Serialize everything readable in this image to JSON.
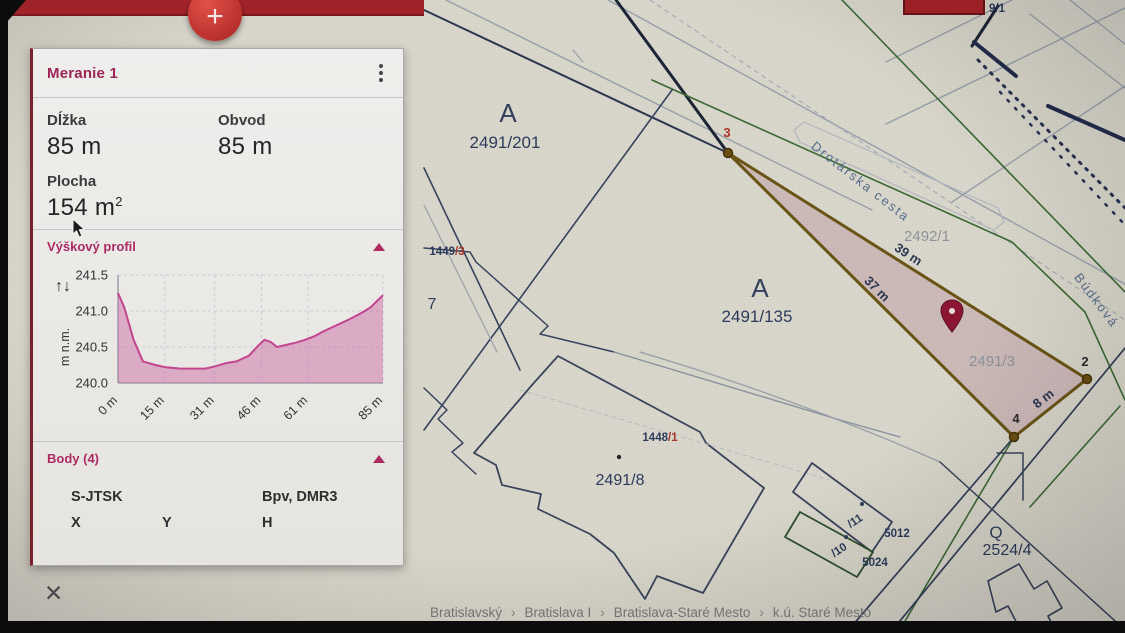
{
  "app": {
    "fab_label": "+",
    "breadcrumb_separator": "›",
    "breadcrumb": [
      "Bratislavský",
      "Bratislava I",
      "Bratislava-Staré Mesto",
      "k.ú. Staré Mesto"
    ]
  },
  "panel": {
    "title": "Meranie 1",
    "close_icon": "✕",
    "metrics": [
      {
        "label": "Dĺžka",
        "value": "85 m",
        "sup": ""
      },
      {
        "label": "Obvod",
        "value": "85 m",
        "sup": ""
      },
      {
        "label": "Plocha",
        "value": "154 m",
        "sup": "2"
      }
    ],
    "sections": {
      "profile": {
        "title": "Výškový profil",
        "collapse_icon": "▲",
        "updown_icon": "↑↓"
      },
      "points": {
        "title": "Body (4)",
        "collapse_icon": "▲",
        "coord_system_headers": [
          {
            "label": "S-JTSK"
          },
          {
            "label": "Bpv, DMR3"
          }
        ],
        "columns": [
          "X",
          "Y",
          "H"
        ]
      }
    }
  },
  "chart_data": {
    "type": "area",
    "title": "Výškový profil",
    "ylabel": "m n.m.",
    "xlabel": "",
    "xlim": [
      0,
      85
    ],
    "ylim": [
      240.0,
      241.5
    ],
    "yticks": [
      240.0,
      240.5,
      241.0,
      241.5
    ],
    "xticks": [
      {
        "pos": 0,
        "label": "0 m"
      },
      {
        "pos": 15,
        "label": "15 m"
      },
      {
        "pos": 31,
        "label": "31 m"
      },
      {
        "pos": 46,
        "label": "46 m"
      },
      {
        "pos": 61,
        "label": "61 m"
      },
      {
        "pos": 85,
        "label": "85 m"
      }
    ],
    "grid": true,
    "line_color": "#c2458f",
    "fill_color": "rgba(201,95,158,0.45)",
    "profile": [
      [
        0,
        241.25
      ],
      [
        2,
        241.05
      ],
      [
        5,
        240.6
      ],
      [
        8,
        240.3
      ],
      [
        12,
        240.25
      ],
      [
        15,
        240.22
      ],
      [
        20,
        240.2
      ],
      [
        25,
        240.2
      ],
      [
        28,
        240.2
      ],
      [
        31,
        240.23
      ],
      [
        35,
        240.28
      ],
      [
        38,
        240.3
      ],
      [
        42,
        240.38
      ],
      [
        45,
        240.52
      ],
      [
        47,
        240.6
      ],
      [
        49,
        240.57
      ],
      [
        51,
        240.5
      ],
      [
        54,
        240.53
      ],
      [
        57,
        240.56
      ],
      [
        60,
        240.6
      ],
      [
        63,
        240.65
      ],
      [
        66,
        240.72
      ],
      [
        70,
        240.8
      ],
      [
        74,
        240.88
      ],
      [
        78,
        240.97
      ],
      [
        81,
        241.05
      ],
      [
        85,
        241.22
      ]
    ]
  },
  "map": {
    "measurement": {
      "area_fill": "rgba(176,124,147,0.30)",
      "edge_color": "#6a5416",
      "points": [
        {
          "n": "3",
          "x": 728,
          "y": 153
        },
        {
          "n": "2",
          "x": 1087,
          "y": 379
        },
        {
          "n": "4",
          "x": 1014,
          "y": 437
        }
      ],
      "edge_labels": [
        "39 m",
        "37 m",
        "8 m"
      ]
    },
    "labels": [
      {
        "t": "A",
        "x": 508,
        "y": 122,
        "cls": "m-symA"
      },
      {
        "t": "2491/201",
        "x": 505,
        "y": 148,
        "cls": "m-navy-lg"
      },
      {
        "t": "A",
        "x": 760,
        "y": 297,
        "cls": "m-symA"
      },
      {
        "t": "2491/135",
        "x": 757,
        "y": 322,
        "cls": "m-navy-lg"
      },
      {
        "t": "2491/8",
        "x": 620,
        "y": 485,
        "cls": "m-navy-md"
      },
      {
        "t": "2492/1",
        "x": 927,
        "y": 241,
        "cls": "m-gray"
      },
      {
        "t": "2491/3",
        "x": 992,
        "y": 366,
        "cls": "m-gray"
      },
      {
        "t": "2524/4",
        "x": 1007,
        "y": 555,
        "cls": "m-navy-md"
      },
      {
        "t": "Q",
        "x": 996,
        "y": 538,
        "cls": "m-symQ"
      },
      {
        "parts": [
          [
            "1449",
            "navy"
          ],
          [
            "/3",
            "red"
          ]
        ],
        "x": 447,
        "y": 255,
        "cls": "m-navy-sm"
      },
      {
        "parts": [
          [
            "1448",
            "navy"
          ],
          [
            "/1",
            "red"
          ]
        ],
        "x": 660,
        "y": 441,
        "cls": "m-navy-sm"
      },
      {
        "t": "7",
        "x": 432,
        "y": 309,
        "cls": "m-navy-md"
      },
      {
        "t": "9/1",
        "x": 997,
        "y": 12,
        "cls": "m-navy-sm"
      },
      {
        "t": "5012",
        "x": 897,
        "y": 537,
        "cls": "m-navy-sm"
      },
      {
        "t": "5024",
        "x": 875,
        "y": 566,
        "cls": "m-navy-sm"
      },
      {
        "t": "/11",
        "x": 857,
        "y": 524,
        "rot": -33,
        "cls": "m-navy-sm"
      },
      {
        "t": "/10",
        "x": 841,
        "y": 553,
        "rot": -33,
        "cls": "m-navy-sm"
      },
      {
        "t": "Drotárska cesta",
        "x": 858,
        "y": 185,
        "rot": 38,
        "cls": "m-street"
      },
      {
        "t": "Búdková",
        "x": 1093,
        "y": 303,
        "rot": 53,
        "cls": "m-street"
      },
      {
        "t": "39 m",
        "x": 906,
        "y": 258,
        "rot": 33,
        "cls": "m-dist"
      },
      {
        "t": "37 m",
        "x": 874,
        "y": 292,
        "rot": 45,
        "cls": "m-dist"
      },
      {
        "t": "8 m",
        "x": 1046,
        "y": 402,
        "rot": -38,
        "cls": "m-dist"
      },
      {
        "t": "3",
        "x": 727,
        "y": 137,
        "cls": "m-pt-red"
      },
      {
        "t": "2",
        "x": 1085,
        "y": 366,
        "cls": "m-pt-dark"
      },
      {
        "t": "4",
        "x": 1016,
        "y": 423,
        "cls": "m-pt-dark"
      }
    ]
  }
}
